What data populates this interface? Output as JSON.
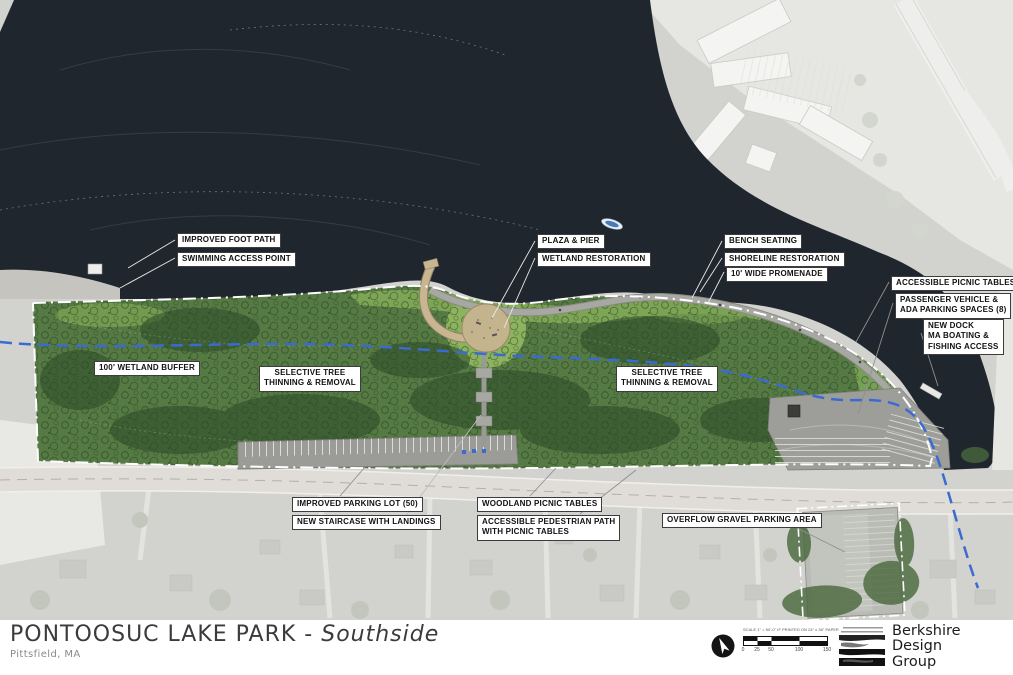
{
  "title_block": {
    "title": "PONTOOSUC LAKE PARK",
    "separator": " - ",
    "subtitle": "Southside",
    "location": "Pittsfield, MA"
  },
  "firm": {
    "line1": "Berkshire",
    "line2": "Design",
    "line3": "Group"
  },
  "scale_bar": {
    "caption": "SCALE 1\" = 50'-0\" IF PRINTED ON 24\" x 36\" PAPER.",
    "ticks": [
      "0",
      "25",
      "50",
      "100",
      "150"
    ]
  },
  "colors": {
    "water": "#20262d",
    "park_green": "#567a44",
    "lawn_green": "#83aa58",
    "pier_tan": "#c9b690",
    "stream_blue": "#3a6bd1",
    "boundary_white": "#ffffff",
    "label_border": "#3c3c3c"
  },
  "map": {
    "annotations": [
      {
        "id": "improved-foot-path",
        "lines": [
          "IMPROVED FOOT PATH"
        ],
        "x": 177,
        "y": 233,
        "center": false,
        "leader": {
          "x1": 175,
          "y1": 240,
          "x2": 128,
          "y2": 268,
          "color": "#e8e8e8"
        }
      },
      {
        "id": "swimming-access-point",
        "lines": [
          "SWIMMING ACCESS POINT"
        ],
        "x": 177,
        "y": 252,
        "center": false,
        "leader": {
          "x1": 175,
          "y1": 258,
          "x2": 120,
          "y2": 288,
          "color": "#e8e8e8"
        }
      },
      {
        "id": "plaza-pier",
        "lines": [
          "PLAZA & PIER"
        ],
        "x": 537,
        "y": 234,
        "center": false,
        "leader": {
          "x1": 535,
          "y1": 241,
          "x2": 492,
          "y2": 318,
          "color": "#e8e8e8"
        }
      },
      {
        "id": "wetland-restoration",
        "lines": [
          "WETLAND RESTORATION"
        ],
        "x": 537,
        "y": 252,
        "center": false,
        "leader": {
          "x1": 535,
          "y1": 258,
          "x2": 504,
          "y2": 328,
          "color": "#e8e8e8"
        }
      },
      {
        "id": "bench-seating",
        "lines": [
          "BENCH SEATING"
        ],
        "x": 724,
        "y": 234,
        "center": false,
        "leader": {
          "x1": 722,
          "y1": 241,
          "x2": 692,
          "y2": 298,
          "color": "#e8e8e8"
        }
      },
      {
        "id": "shoreline-restoration",
        "lines": [
          "SHORELINE RESTORATION"
        ],
        "x": 724,
        "y": 252,
        "center": false,
        "leader": {
          "x1": 722,
          "y1": 258,
          "x2": 700,
          "y2": 292,
          "color": "#e8e8e8"
        }
      },
      {
        "id": "wide-promenade",
        "lines": [
          "10' WIDE PROMENADE"
        ],
        "x": 726,
        "y": 267,
        "center": false,
        "leader": {
          "x1": 724,
          "y1": 272,
          "x2": 708,
          "y2": 303,
          "color": "#e8e8e8"
        }
      },
      {
        "id": "accessible-picnic-tables",
        "lines": [
          "ACCESSIBLE PICNIC TABLES"
        ],
        "x": 891,
        "y": 276,
        "center": false,
        "leader": {
          "x1": 889,
          "y1": 282,
          "x2": 856,
          "y2": 342,
          "color": "#8f8f8f"
        }
      },
      {
        "id": "passenger-vehicle-ada",
        "lines": [
          "PASSENGER VEHICLE &",
          "ADA PARKING SPACES (8)"
        ],
        "x": 895,
        "y": 293,
        "center": false,
        "leader": {
          "x1": 893,
          "y1": 303,
          "x2": 858,
          "y2": 414,
          "color": "#8f8f8f"
        }
      },
      {
        "id": "new-dock",
        "lines": [
          "NEW DOCK",
          "MA BOATING &",
          "FISHING ACCESS"
        ],
        "x": 923,
        "y": 319,
        "center": false,
        "leader": {
          "x1": 921,
          "y1": 333,
          "x2": 938,
          "y2": 386,
          "color": "#8f8f8f"
        }
      },
      {
        "id": "wetland-buffer",
        "lines": [
          "100' WETLAND BUFFER"
        ],
        "x": 94,
        "y": 361,
        "center": false,
        "leader": null
      },
      {
        "id": "selective-tree-west",
        "lines": [
          "SELECTIVE TREE",
          "THINNING & REMOVAL"
        ],
        "x": 259,
        "y": 366,
        "center": true,
        "leader": null
      },
      {
        "id": "selective-tree-east",
        "lines": [
          "SELECTIVE TREE",
          "THINNING & REMOVAL"
        ],
        "x": 616,
        "y": 366,
        "center": true,
        "leader": null
      },
      {
        "id": "improved-parking-lot",
        "lines": [
          "IMPROVED PARKING LOT (50)"
        ],
        "x": 292,
        "y": 497,
        "center": false,
        "leader": {
          "x1": 340,
          "y1": 496,
          "x2": 365,
          "y2": 467,
          "color": "#8f8f8f"
        }
      },
      {
        "id": "new-staircase",
        "lines": [
          "NEW STAIRCASE WITH LANDINGS"
        ],
        "x": 292,
        "y": 515,
        "center": false,
        "leader": {
          "x1": 402,
          "y1": 521,
          "x2": 481,
          "y2": 415,
          "color": "#bdbdbd"
        }
      },
      {
        "id": "woodland-picnic-tables",
        "lines": [
          "WOODLAND PICNIC TABLES"
        ],
        "x": 477,
        "y": 497,
        "center": false,
        "leader": {
          "x1": 530,
          "y1": 496,
          "x2": 556,
          "y2": 468,
          "color": "#8f8f8f"
        }
      },
      {
        "id": "accessible-pedestrian-path",
        "lines": [
          "ACCESSIBLE PEDESTRIAN PATH",
          "WITH PICNIC TABLES"
        ],
        "x": 477,
        "y": 515,
        "center": false,
        "leader": {
          "x1": 580,
          "y1": 514,
          "x2": 636,
          "y2": 470,
          "color": "#8f8f8f"
        }
      },
      {
        "id": "overflow-gravel-parking",
        "lines": [
          "OVERFLOW GRAVEL PARKING AREA"
        ],
        "x": 662,
        "y": 513,
        "center": false,
        "leader": {
          "x1": 781,
          "y1": 520,
          "x2": 845,
          "y2": 552,
          "color": "#8f8f8f"
        }
      }
    ]
  }
}
